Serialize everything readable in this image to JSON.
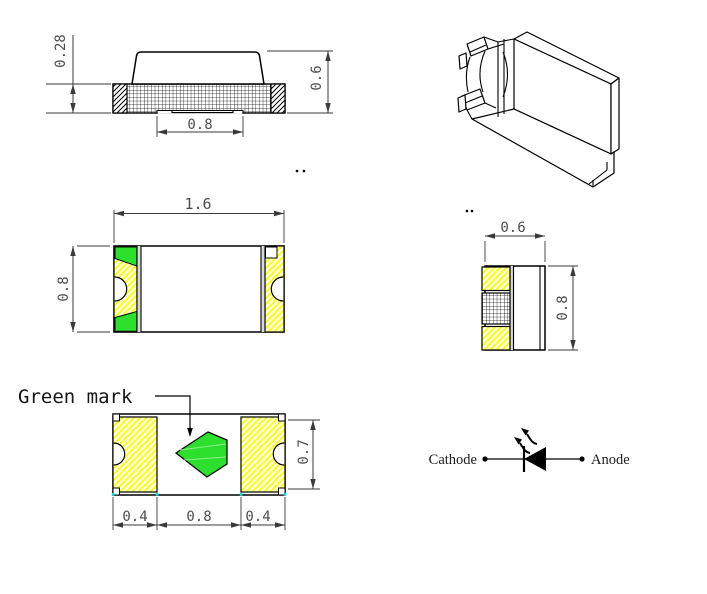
{
  "drawing": {
    "side_view": {
      "dim_base_height": "0.28",
      "dim_total_height": "0.6",
      "dim_pad_width": "0.8"
    },
    "top_view": {
      "dim_length": "1.6",
      "dim_width": "0.8"
    },
    "end_view": {
      "dim_width": "0.6",
      "dim_height": "0.8"
    },
    "bottom_view": {
      "label_green_mark": "Green mark",
      "dim_left_pad": "0.4",
      "dim_center_pad": "0.8",
      "dim_right_pad": "0.4",
      "dim_pad_height": "0.7"
    },
    "polarity_symbol": {
      "cathode_label": "Cathode",
      "anode_label": "Anode"
    },
    "colors": {
      "mark_green": "#2de02d",
      "pad_yellow": "#ffff00",
      "line_black": "#000000",
      "dim_gray": "#4d4d4d",
      "tick_cyan": "#00e5e5"
    }
  }
}
